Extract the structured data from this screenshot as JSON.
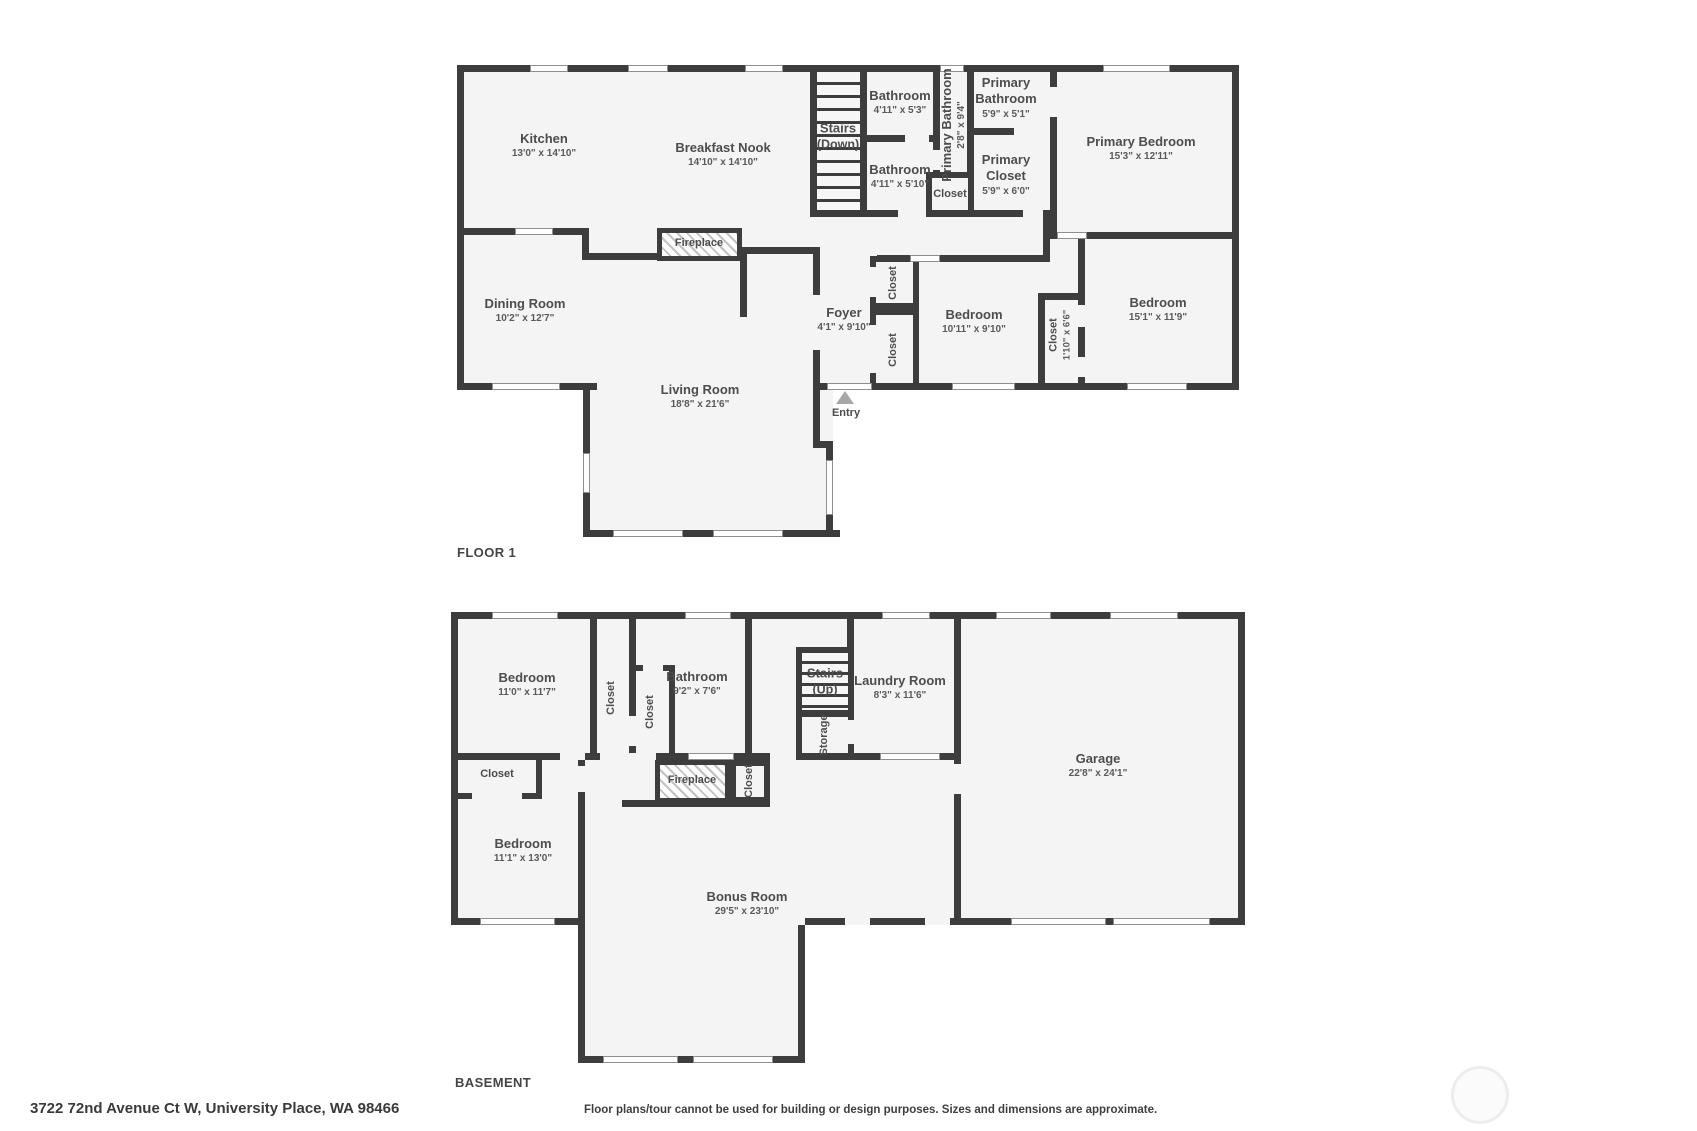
{
  "page": {
    "background": "#ffffff",
    "wall_color": "#3d3d3d",
    "floor_color": "#f4f4f4"
  },
  "floor1": {
    "title": "FLOOR 1",
    "rooms": [
      {
        "name": "Kitchen",
        "dim": "13'0\" x 14'10\""
      },
      {
        "name": "Breakfast Nook",
        "dim": "14'10\" x 14'10\""
      },
      {
        "name": "Stairs",
        "dim": "(Down)"
      },
      {
        "name": "Bathroom",
        "dim": "4'11\" x 5'3\""
      },
      {
        "name": "Primary Bathroom",
        "dim": "2'8\" x 9'4\""
      },
      {
        "name": "Primary Bathroom",
        "dim": "5'9\" x 5'1\""
      },
      {
        "name": "Primary Closet",
        "dim": "5'9\" x 6'0\""
      },
      {
        "name": "Closet"
      },
      {
        "name": "Primary Bedroom",
        "dim": "15'3\" x 12'11\""
      },
      {
        "name": "Bathroom",
        "dim": "4'11\" x 5'10\""
      },
      {
        "name": "Dining Room",
        "dim": "10'2\" x 12'7\""
      },
      {
        "name": "Fireplace"
      },
      {
        "name": "Foyer",
        "dim": "4'1\" x 9'10\""
      },
      {
        "name": "Closet"
      },
      {
        "name": "Closet"
      },
      {
        "name": "Bedroom",
        "dim": "10'11\" x 9'10\""
      },
      {
        "name": "Closet",
        "dim": "1'10\" x 6'6\""
      },
      {
        "name": "Bedroom",
        "dim": "15'1\" x 11'9\""
      },
      {
        "name": "Living Room",
        "dim": "18'8\" x 21'6\""
      },
      {
        "name": "Entry"
      }
    ]
  },
  "basement": {
    "title": "BASEMENT",
    "rooms": [
      {
        "name": "Bedroom",
        "dim": "11'0\" x 11'7\""
      },
      {
        "name": "Closet"
      },
      {
        "name": "Closet"
      },
      {
        "name": "Bathroom",
        "dim": "9'2\" x 7'6\""
      },
      {
        "name": "Stairs",
        "dim": "(Up)"
      },
      {
        "name": "Storage"
      },
      {
        "name": "Laundry Room",
        "dim": "8'3\" x 11'6\""
      },
      {
        "name": "Garage",
        "dim": "22'8\" x 24'1\""
      },
      {
        "name": "Closet"
      },
      {
        "name": "Fireplace"
      },
      {
        "name": "Closet"
      },
      {
        "name": "Bedroom",
        "dim": "11'1\" x 13'0\""
      },
      {
        "name": "Bonus Room",
        "dim": "29'5\" x 23'10\""
      }
    ]
  },
  "footer": {
    "address": "3722 72nd Avenue Ct W, University Place, WA 98466",
    "disclaimer": "Floor plans/tour cannot be used for building or design purposes. Sizes and dimensions are approximate."
  }
}
